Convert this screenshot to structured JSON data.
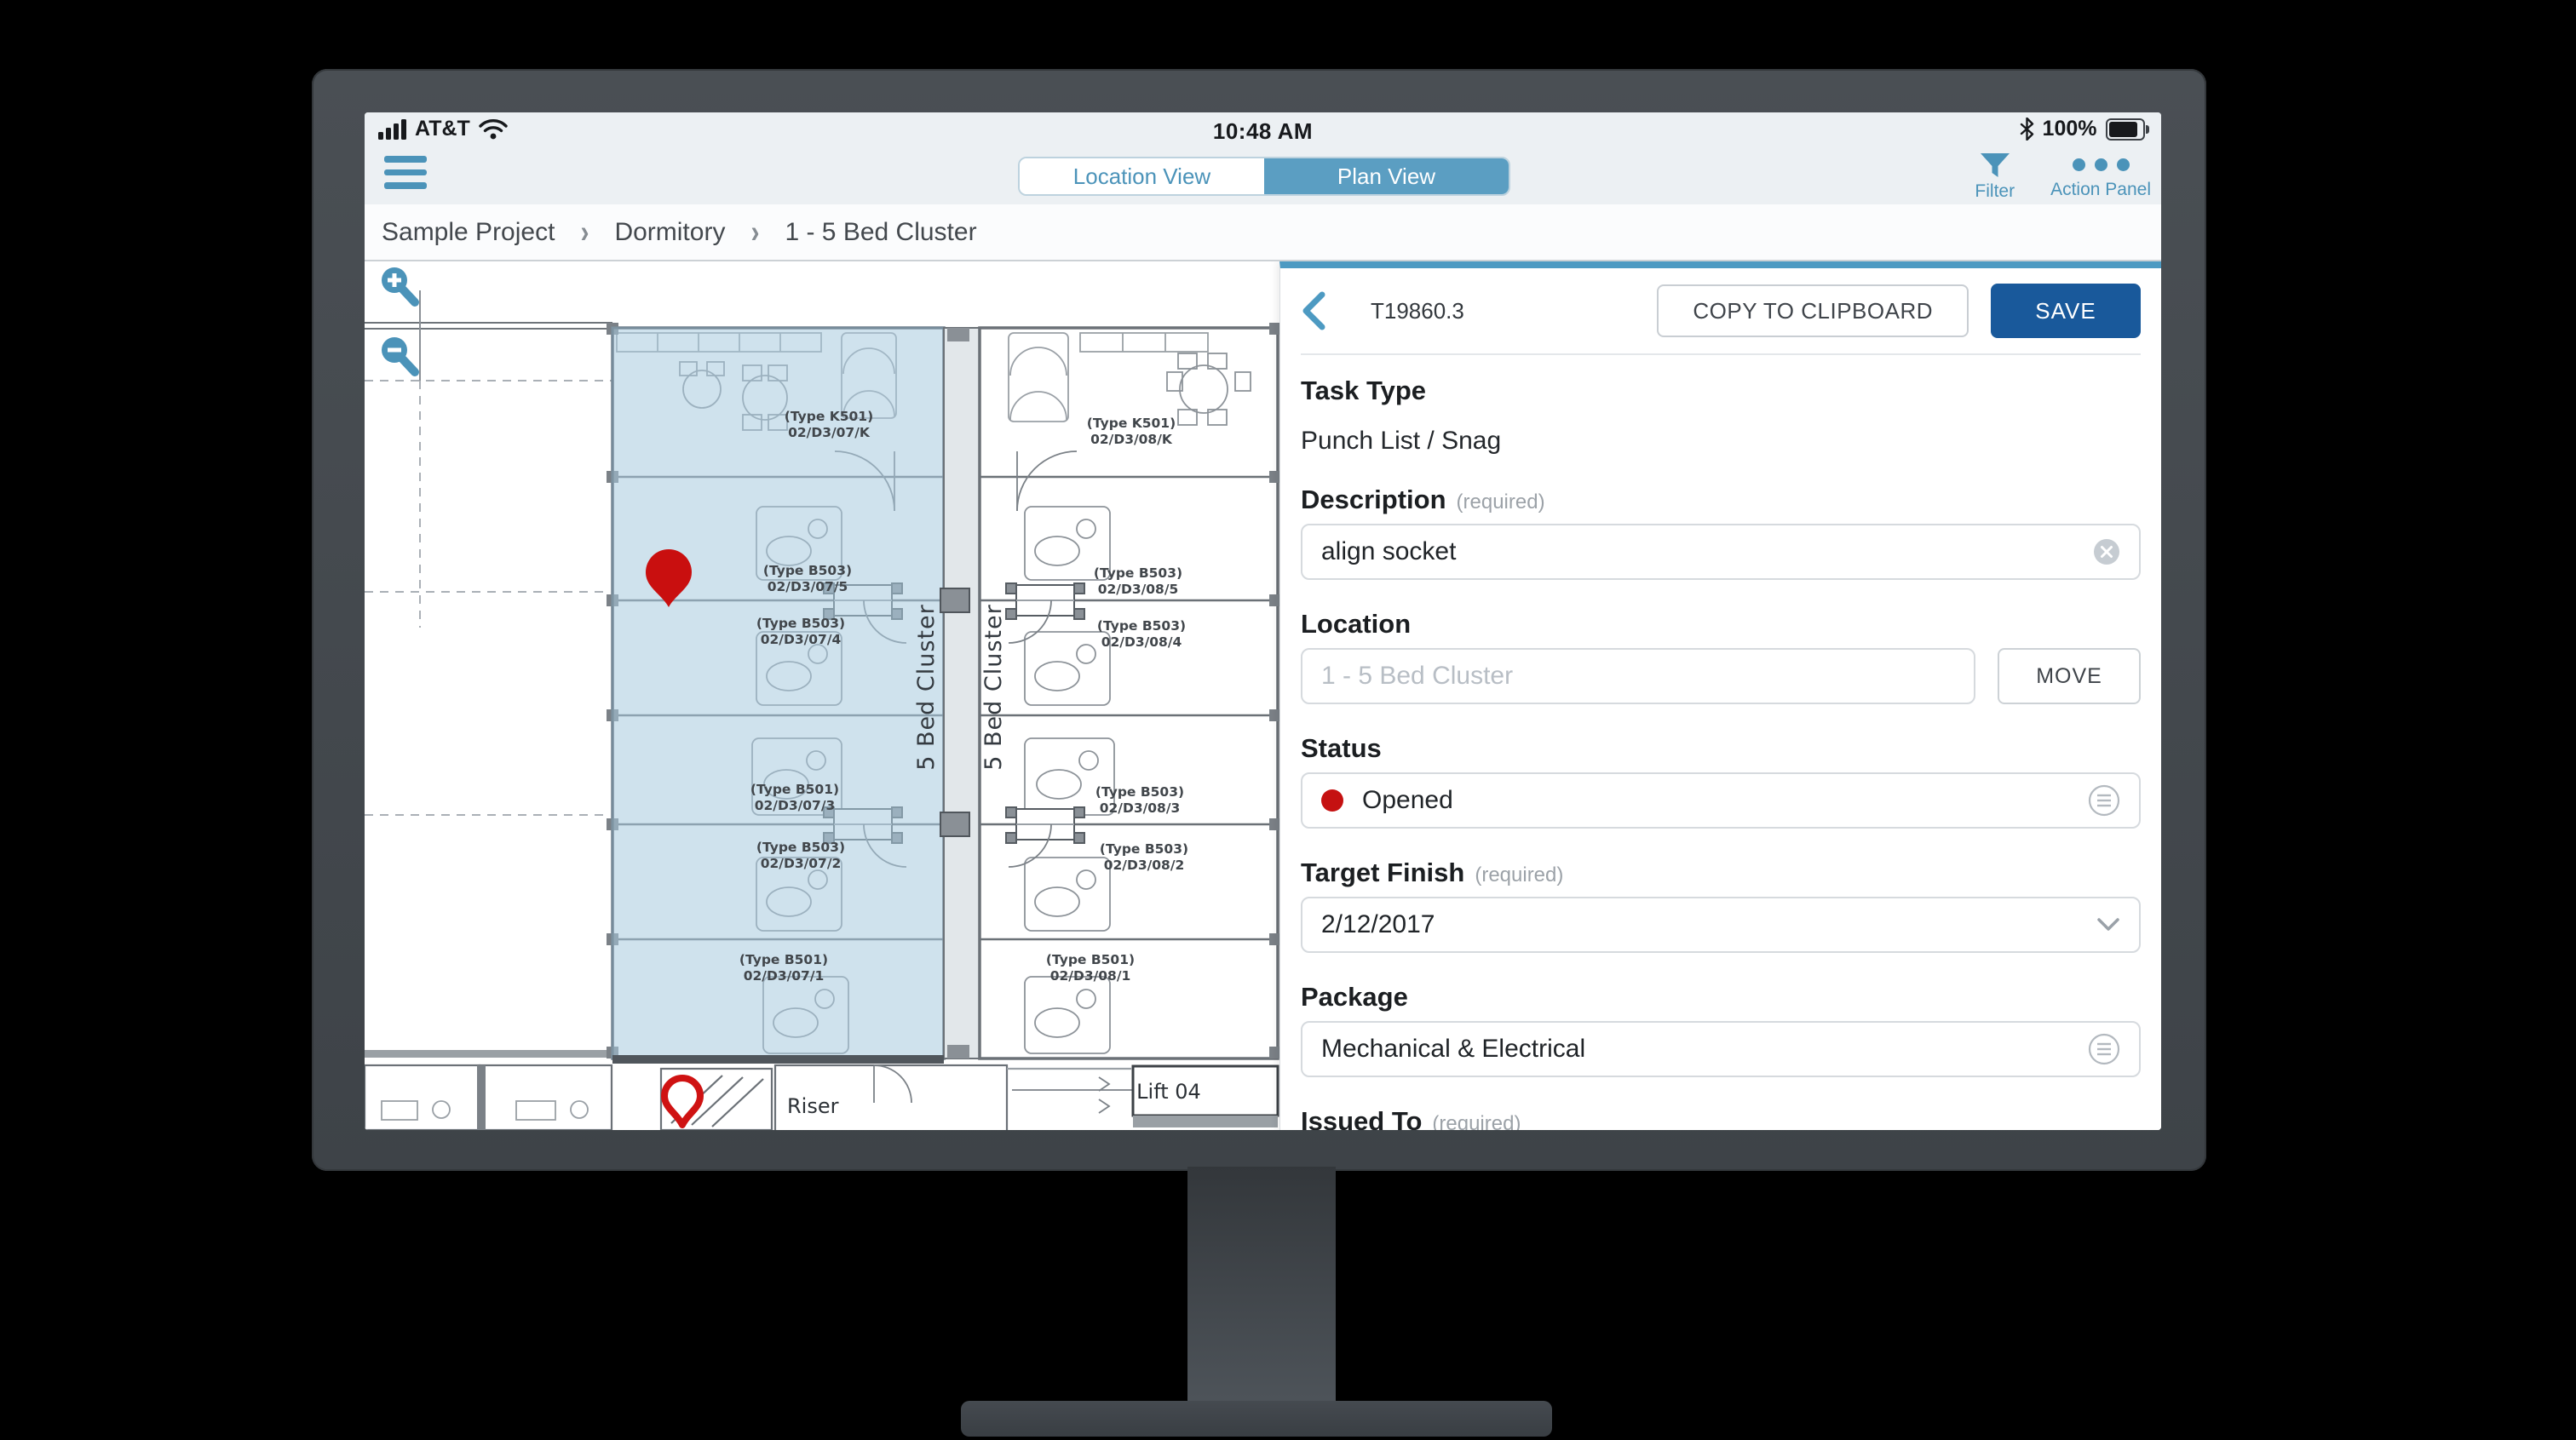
{
  "status_bar": {
    "carrier": "AT&T",
    "time": "10:48 AM",
    "battery": "100%"
  },
  "toolbar": {
    "toggle": {
      "left": "Location View",
      "right": "Plan View",
      "selected": "Plan View"
    },
    "filter_label": "Filter",
    "action_panel_label": "Action Panel"
  },
  "breadcrumb": {
    "items": [
      "Sample Project",
      "Dormitory",
      "1 - 5 Bed Cluster"
    ],
    "separator": "›"
  },
  "plan": {
    "clusters": [
      {
        "name": "5 Bed Cluster",
        "rooms": [
          {
            "type": "(Type K501)",
            "code": "02/D3/07/K"
          },
          {
            "type": "(Type B503)",
            "code": "02/D3/07/5"
          },
          {
            "type": "(Type B503)",
            "code": "02/D3/07/4"
          },
          {
            "type": "(Type B501)",
            "code": "02/D3/07/3"
          },
          {
            "type": "(Type B503)",
            "code": "02/D3/07/2"
          },
          {
            "type": "(Type B501)",
            "code": "02/D3/07/1"
          }
        ]
      },
      {
        "name": "5 Bed Cluster",
        "rooms": [
          {
            "type": "(Type K501)",
            "code": "02/D3/08/K"
          },
          {
            "type": "(Type B503)",
            "code": "02/D3/08/5"
          },
          {
            "type": "(Type B503)",
            "code": "02/D3/08/4"
          },
          {
            "type": "(Type B503)",
            "code": "02/D3/08/3"
          },
          {
            "type": "(Type B503)",
            "code": "02/D3/08/2"
          },
          {
            "type": "(Type B501)",
            "code": "02/D3/08/1"
          }
        ]
      }
    ],
    "riser_label": "Riser",
    "lift_label": "Lift 04"
  },
  "panel": {
    "task_id": "T19860.3",
    "copy_button": "COPY TO CLIPBOARD",
    "save_button": "SAVE",
    "fields": {
      "task_type": {
        "label": "Task Type",
        "value": "Punch List / Snag"
      },
      "description": {
        "label": "Description",
        "required": "(required)",
        "value": "align socket"
      },
      "location": {
        "label": "Location",
        "value": "1 - 5 Bed Cluster",
        "move_button": "MOVE"
      },
      "status": {
        "label": "Status",
        "value": "Opened"
      },
      "target_finish": {
        "label": "Target Finish",
        "required": "(required)",
        "value": "2/12/2017"
      },
      "package": {
        "label": "Package",
        "value": "Mechanical & Electrical"
      },
      "issued_to": {
        "label": "Issued To",
        "required": "(required)",
        "value": "Oak Mechanical"
      }
    }
  },
  "colors": {
    "accent_blue": "#4b93b9",
    "toggle_blue": "#5b9ec2",
    "save_blue": "#19599b",
    "panel_top_border": "#4d9ac2",
    "status_red": "#c51111",
    "pin_red": "#c90f0f",
    "plan_highlight": "#a9cbdf",
    "chrome_bg": "#ecf0f3"
  }
}
